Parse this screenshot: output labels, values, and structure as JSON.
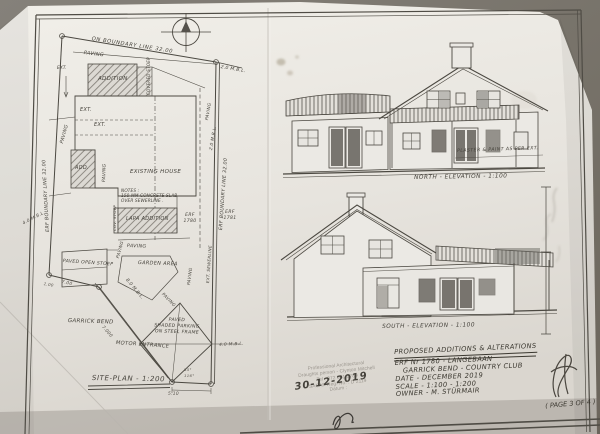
{
  "site_plan": {
    "title": "SITE-PLAN - 1:200",
    "boundary_top": "ON BOUNDARY LINE 32.00",
    "boundary_left": "ERF BOUNDARY LINE 32.00",
    "boundary_right": "ERF BOUNDARY LINE 32.00",
    "paving": "PAVING",
    "ext": "EXT.",
    "add_label": "ADD.",
    "addition": "ADDITION",
    "covered_stoep": "COVERED STOEP",
    "cov_stoep": "COV. STOEP",
    "existing_house": "EXISTING HOUSE",
    "lapa_addition": "LAPA ADDITION",
    "erf_1780": "ERF 1780",
    "erf_1781": "ERF 1781",
    "notes_line1": "NOTES :",
    "notes_line2": "150 MM CONCRETE SLAB",
    "notes_line3": "OVER SEWERLINE .",
    "sewerline": "EXT. SEWERLINE",
    "paved_open_stoep": "PAVED OPEN STOEP",
    "garden_area": "GARDEN AREA",
    "parking_line1": "PAVED",
    "parking_line2": "SHADED PARKING",
    "parking_line3": "ON STEEL FRAME",
    "street_name": "GARRICK BEND",
    "motor_entrance": "MOTOR ENTRANCE",
    "bl_2m": "2.0 M.B.L.",
    "bl_4m": "4.0 M.B.L.",
    "bl_8m": "8.0 M.B.L.",
    "dim_1": "1.00",
    "dim_7": "7.00",
    "dim_7000": "7.000",
    "dim_510": "5.10",
    "dim_55": "55°",
    "dim_116": "116°"
  },
  "elevations": {
    "north_label": "NORTH - ELEVATION - 1:100",
    "south_label": "SOUTH - ELEVATION - 1:100",
    "finish_note": "PLASTER & PAINT AS PER EXT."
  },
  "stamp": {
    "line1": "Professional Architectural",
    "line2": "Draughts person - Clynton Mitchell",
    "line3": "Tel : 072 381 5789",
    "line4": "SACAP Reg. No. : D 2119",
    "line5": "Datum :",
    "handwritten_date": "30-12-2019"
  },
  "title_block": {
    "project": "PROPOSED ADDITIONS & ALTERATIONS",
    "erf": "ERF Nr 1780 - LANGEBAAN",
    "location": "GARRICK BEND - COUNTRY CLUB",
    "date": "DATE - DECEMBER 2019",
    "scale": "SCALE - 1:100 - 1:200",
    "owner": "OWNER - M. STÜRMAIR",
    "page": "( PAGE 3 OF 4 )"
  }
}
